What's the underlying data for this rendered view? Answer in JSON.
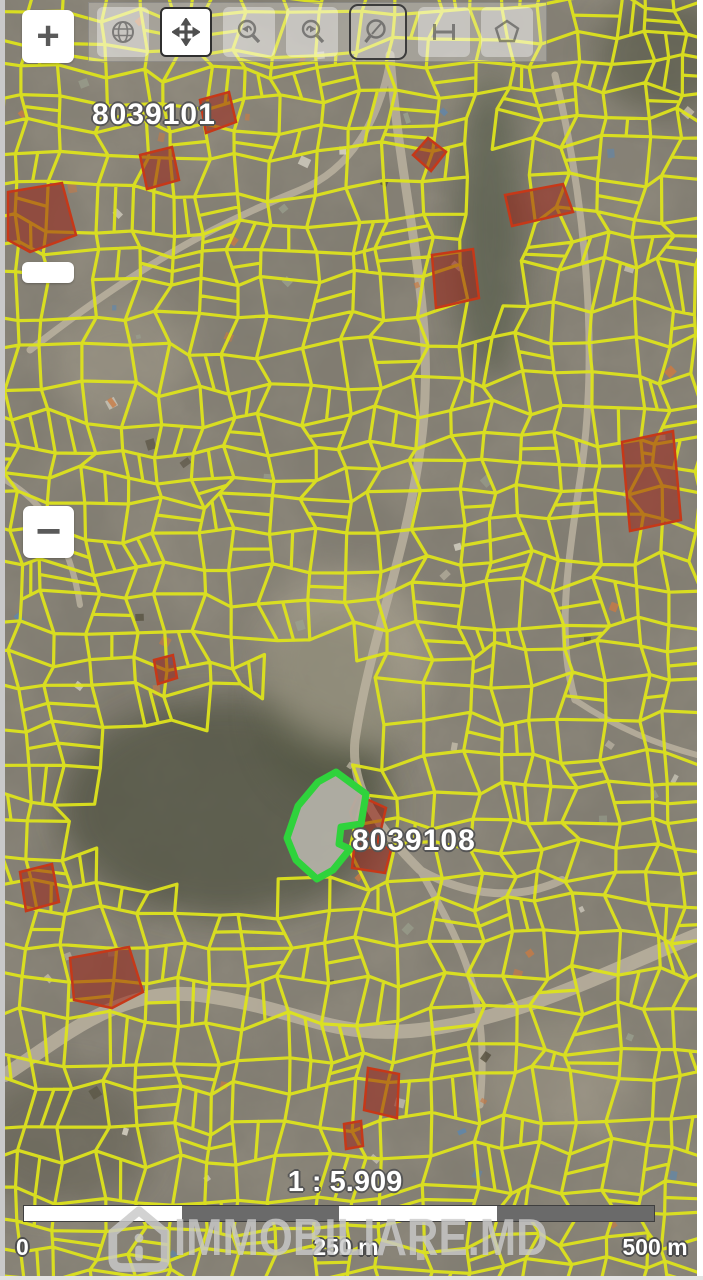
{
  "zoom_controls": {
    "zoom_in_label": "+",
    "zoom_out_label": "−"
  },
  "toolbar": {
    "tools": [
      {
        "id": "full-extent",
        "icon": "globe-icon",
        "active": false,
        "framed": false
      },
      {
        "id": "pan",
        "icon": "pan-arrows-icon",
        "active": true,
        "framed": false
      },
      {
        "id": "zoom-previous",
        "icon": "magnifier-back-icon",
        "active": false,
        "framed": false
      },
      {
        "id": "zoom-next",
        "icon": "magnifier-forward-icon",
        "active": false,
        "framed": false
      },
      {
        "id": "zoom-box",
        "icon": "magnifier-icon",
        "active": false,
        "framed": true
      },
      {
        "id": "measure-distance",
        "icon": "ruler-icon",
        "active": false,
        "framed": false
      },
      {
        "id": "measure-area",
        "icon": "polygon-icon",
        "active": false,
        "framed": false
      }
    ]
  },
  "map": {
    "cadastral_labels": [
      {
        "text": "8039101",
        "x": 92,
        "y": 98
      },
      {
        "text": "8039108",
        "x": 352,
        "y": 824
      }
    ],
    "selected_parcel": {
      "points": "336,772 366,794 361,824 341,827 339,844 350,849 333,870 317,879 296,860 287,838 298,806 318,782",
      "stroke": "#2fd33c",
      "fill": "rgba(180,178,168,0.92)"
    },
    "red_parcels": [
      "8,192 62,183 76,235 30,252 8,240",
      "140,155 172,147 179,180 147,189",
      "200,100 229,92 236,122 206,133",
      "428,138 446,152 431,171 413,155",
      "505,195 563,184 573,212 512,226",
      "432,255 473,249 479,298 436,308",
      "622,442 673,431 681,520 630,531",
      "154,660 173,655 177,678 158,684",
      "20,872 52,864 59,902 26,911",
      "70,958 129,947 143,992 112,1008 74,1000",
      "368,1068 399,1074 397,1118 364,1110",
      "344,1124 361,1121 363,1146 346,1149",
      "358,795 386,808 378,842 391,850 385,873 352,868 356,830 350,812"
    ],
    "colors": {
      "parcel_line": "#dde31c",
      "red_fill": "rgba(155,35,22,0.55)",
      "red_stroke": "#c63818"
    }
  },
  "scale": {
    "ratio_text": "1 : 5.909",
    "bar_segments": [
      "#ffffff",
      "#6a6a6a",
      "#ffffff",
      "#6a6a6a"
    ],
    "tick_labels": [
      "0",
      "250 m",
      "500 m"
    ]
  },
  "watermark": {
    "text": "IMMOBILIARE.MD",
    "icon": "immobiliare-house-icon"
  }
}
